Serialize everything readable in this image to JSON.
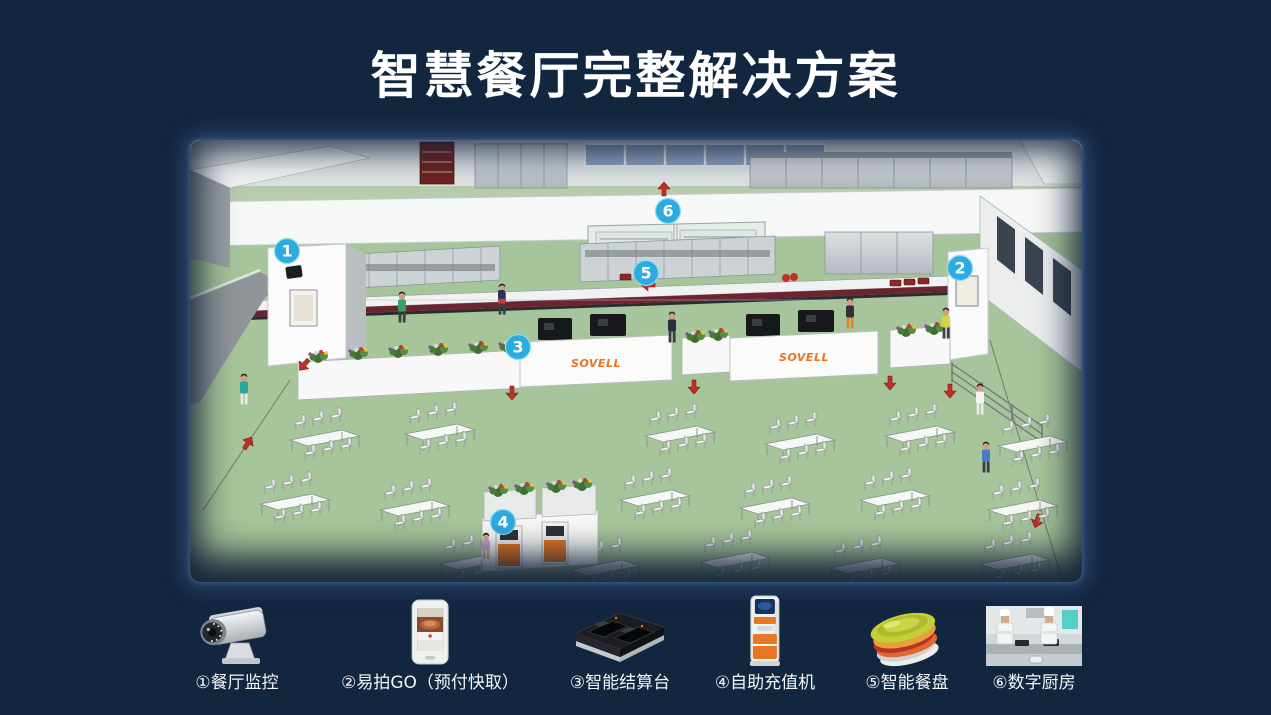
{
  "page": {
    "title": "智慧餐厅完整解决方案"
  },
  "scene": {
    "counter_brand": "SOVELL",
    "markers": [
      {
        "num": "1",
        "refers_to": "餐厅监控"
      },
      {
        "num": "2",
        "refers_to": "易拍GO（预付快取）"
      },
      {
        "num": "3",
        "refers_to": "智能结算台"
      },
      {
        "num": "4",
        "refers_to": "自助充值机"
      },
      {
        "num": "5",
        "refers_to": "智能餐盘"
      },
      {
        "num": "6",
        "refers_to": "数字厨房"
      }
    ]
  },
  "legend": {
    "items": [
      {
        "label": "①餐厅监控",
        "icon": "cctv-camera-icon"
      },
      {
        "label": "②易拍GO（预付快取）",
        "icon": "easypai-go-device-icon"
      },
      {
        "label": "③智能结算台",
        "icon": "smart-checkout-terminal-icon"
      },
      {
        "label": "④自助充值机",
        "icon": "self-recharge-kiosk-icon"
      },
      {
        "label": "⑤智能餐盘",
        "icon": "smart-plates-icon"
      },
      {
        "label": "⑥数字厨房",
        "icon": "digital-kitchen-icon"
      }
    ]
  },
  "colors": {
    "background": "#122640",
    "marker_blue": "#2dabdf",
    "brand_orange": "#e8751e",
    "floor_green": "#a7c59a",
    "title_text": "#ffffff"
  }
}
